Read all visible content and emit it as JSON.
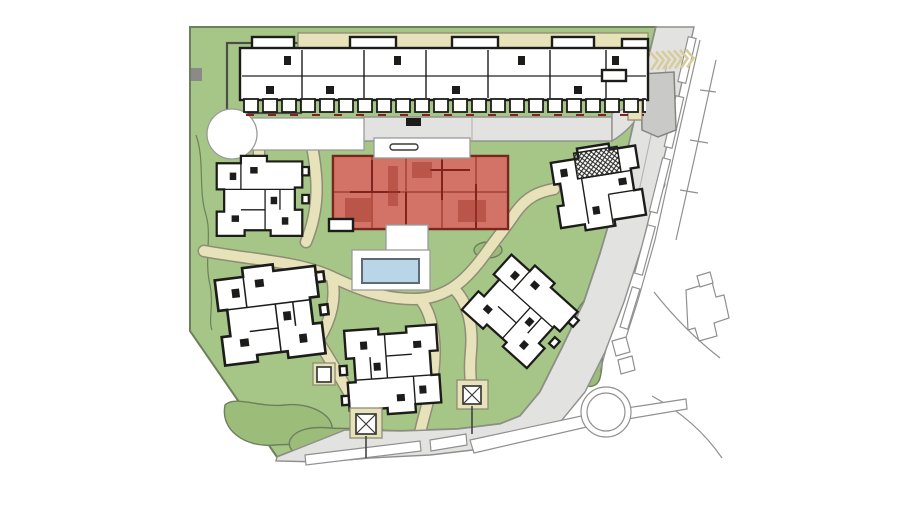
{
  "document": {
    "type": "architectural-site-plan",
    "visible_text": "",
    "selection": {
      "highlighted_building": "central-building",
      "state": "selected"
    }
  },
  "colors": {
    "site-green": "#a6c687",
    "bush-green": "#9cbd7a",
    "outline-green": "#6e7f5d",
    "path-beige": "#e8e2bb",
    "path-outline": "#8e8d76",
    "road-gray": "#e2e2e0",
    "road-outline": "#8f8f8d",
    "plaza-white": "#ffffff",
    "plaza-outline": "#9a9a98",
    "wall-black": "#1c1c1a",
    "highlight-red": "#c74a3b",
    "highlight-wall": "#7e241c",
    "pool-blue": "#bad4e8",
    "pool-outline": "#5d6b75",
    "gray-building": "#c9c9c7",
    "offsite-outline": "#909090",
    "chevron-beige": "#d6cc9c",
    "hedge-outline": "#4d4d49"
  },
  "features": {
    "buildings": [
      {
        "id": "north-slab-building",
        "highlighted": false
      },
      {
        "id": "west-building",
        "highlighted": false
      },
      {
        "id": "central-building",
        "highlighted": true
      },
      {
        "id": "northeast-building",
        "highlighted": false
      },
      {
        "id": "southwest-building",
        "highlighted": false
      },
      {
        "id": "south-building",
        "highlighted": false
      },
      {
        "id": "southeast-building",
        "highlighted": false
      }
    ],
    "amenities": [
      {
        "id": "swimming-pool"
      },
      {
        "id": "pool-deck"
      },
      {
        "id": "playground-court"
      },
      {
        "id": "cul-de-sac"
      },
      {
        "id": "garage-ramp-chevrons"
      },
      {
        "id": "pavilion-west"
      },
      {
        "id": "pavilion-east"
      },
      {
        "id": "roundabout"
      }
    ],
    "circulation": [
      {
        "id": "north-access-road"
      },
      {
        "id": "east-perimeter-road"
      },
      {
        "id": "footpath-network"
      }
    ]
  }
}
